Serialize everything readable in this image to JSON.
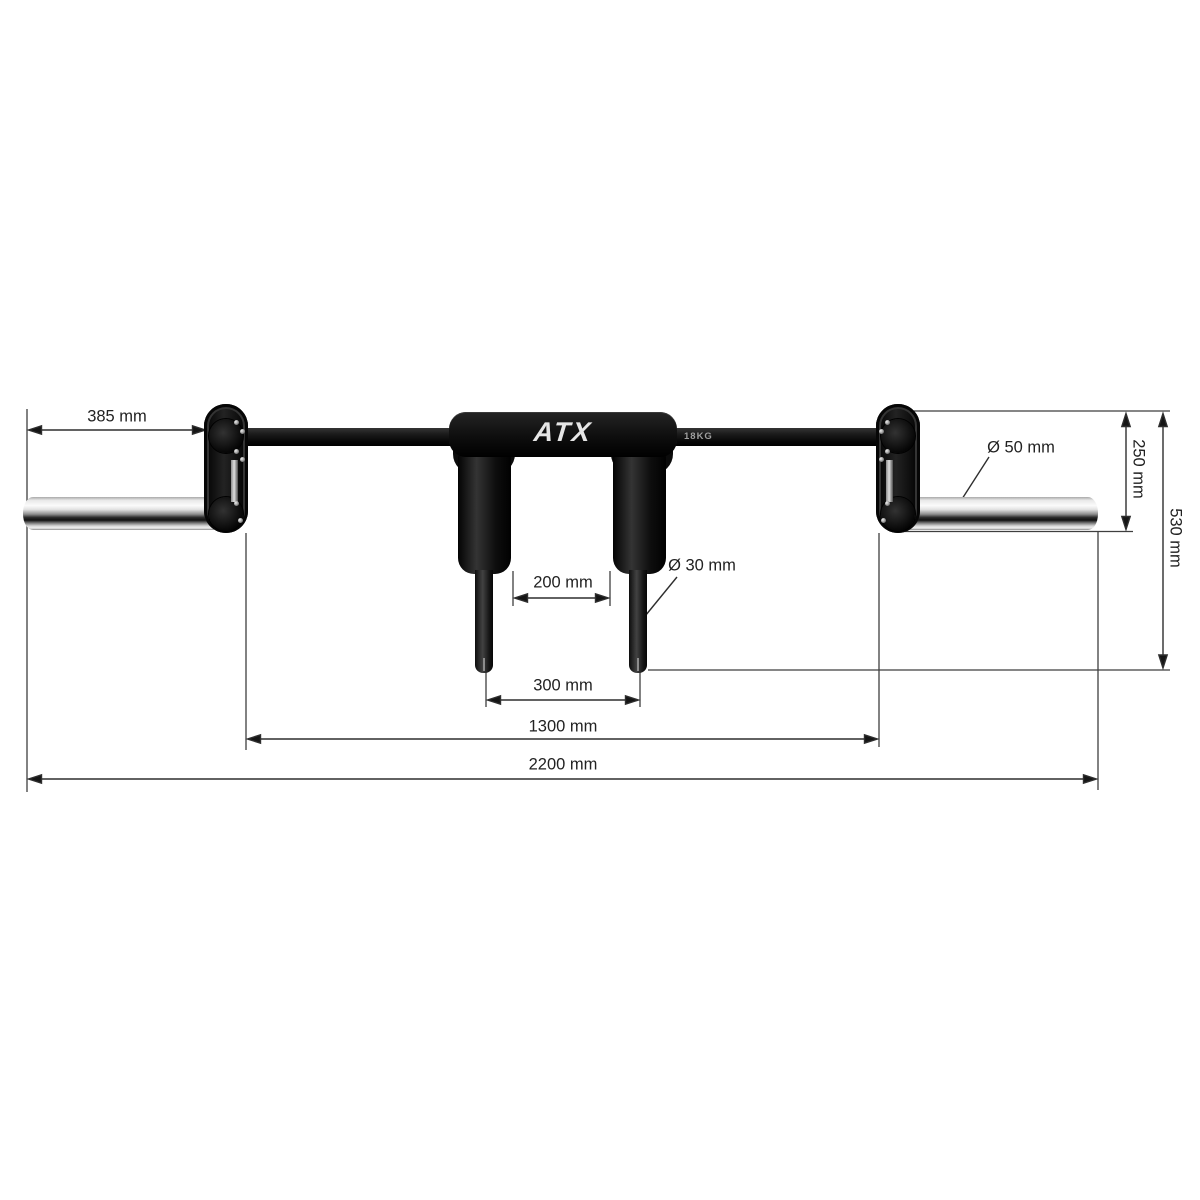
{
  "product": {
    "brand": "ATX",
    "weight_marking": "18KG"
  },
  "dimensions": {
    "sleeve_length": "385 mm",
    "grip_inner_spacing": "200 mm",
    "peg_spacing": "300 mm",
    "inner_length": "1300 mm",
    "total_length": "2200 mm",
    "sleeve_drop": "250 mm",
    "total_drop": "530 mm",
    "sleeve_diameter": "Ø 50 mm",
    "peg_diameter": "Ø 30 mm"
  },
  "colors": {
    "background": "#ffffff",
    "dimension_line": "#3f3f3f",
    "arrowhead": "#151515",
    "label_text": "#222222",
    "product_black": "#111111",
    "chrome_highlight": "#f7f7f7"
  }
}
